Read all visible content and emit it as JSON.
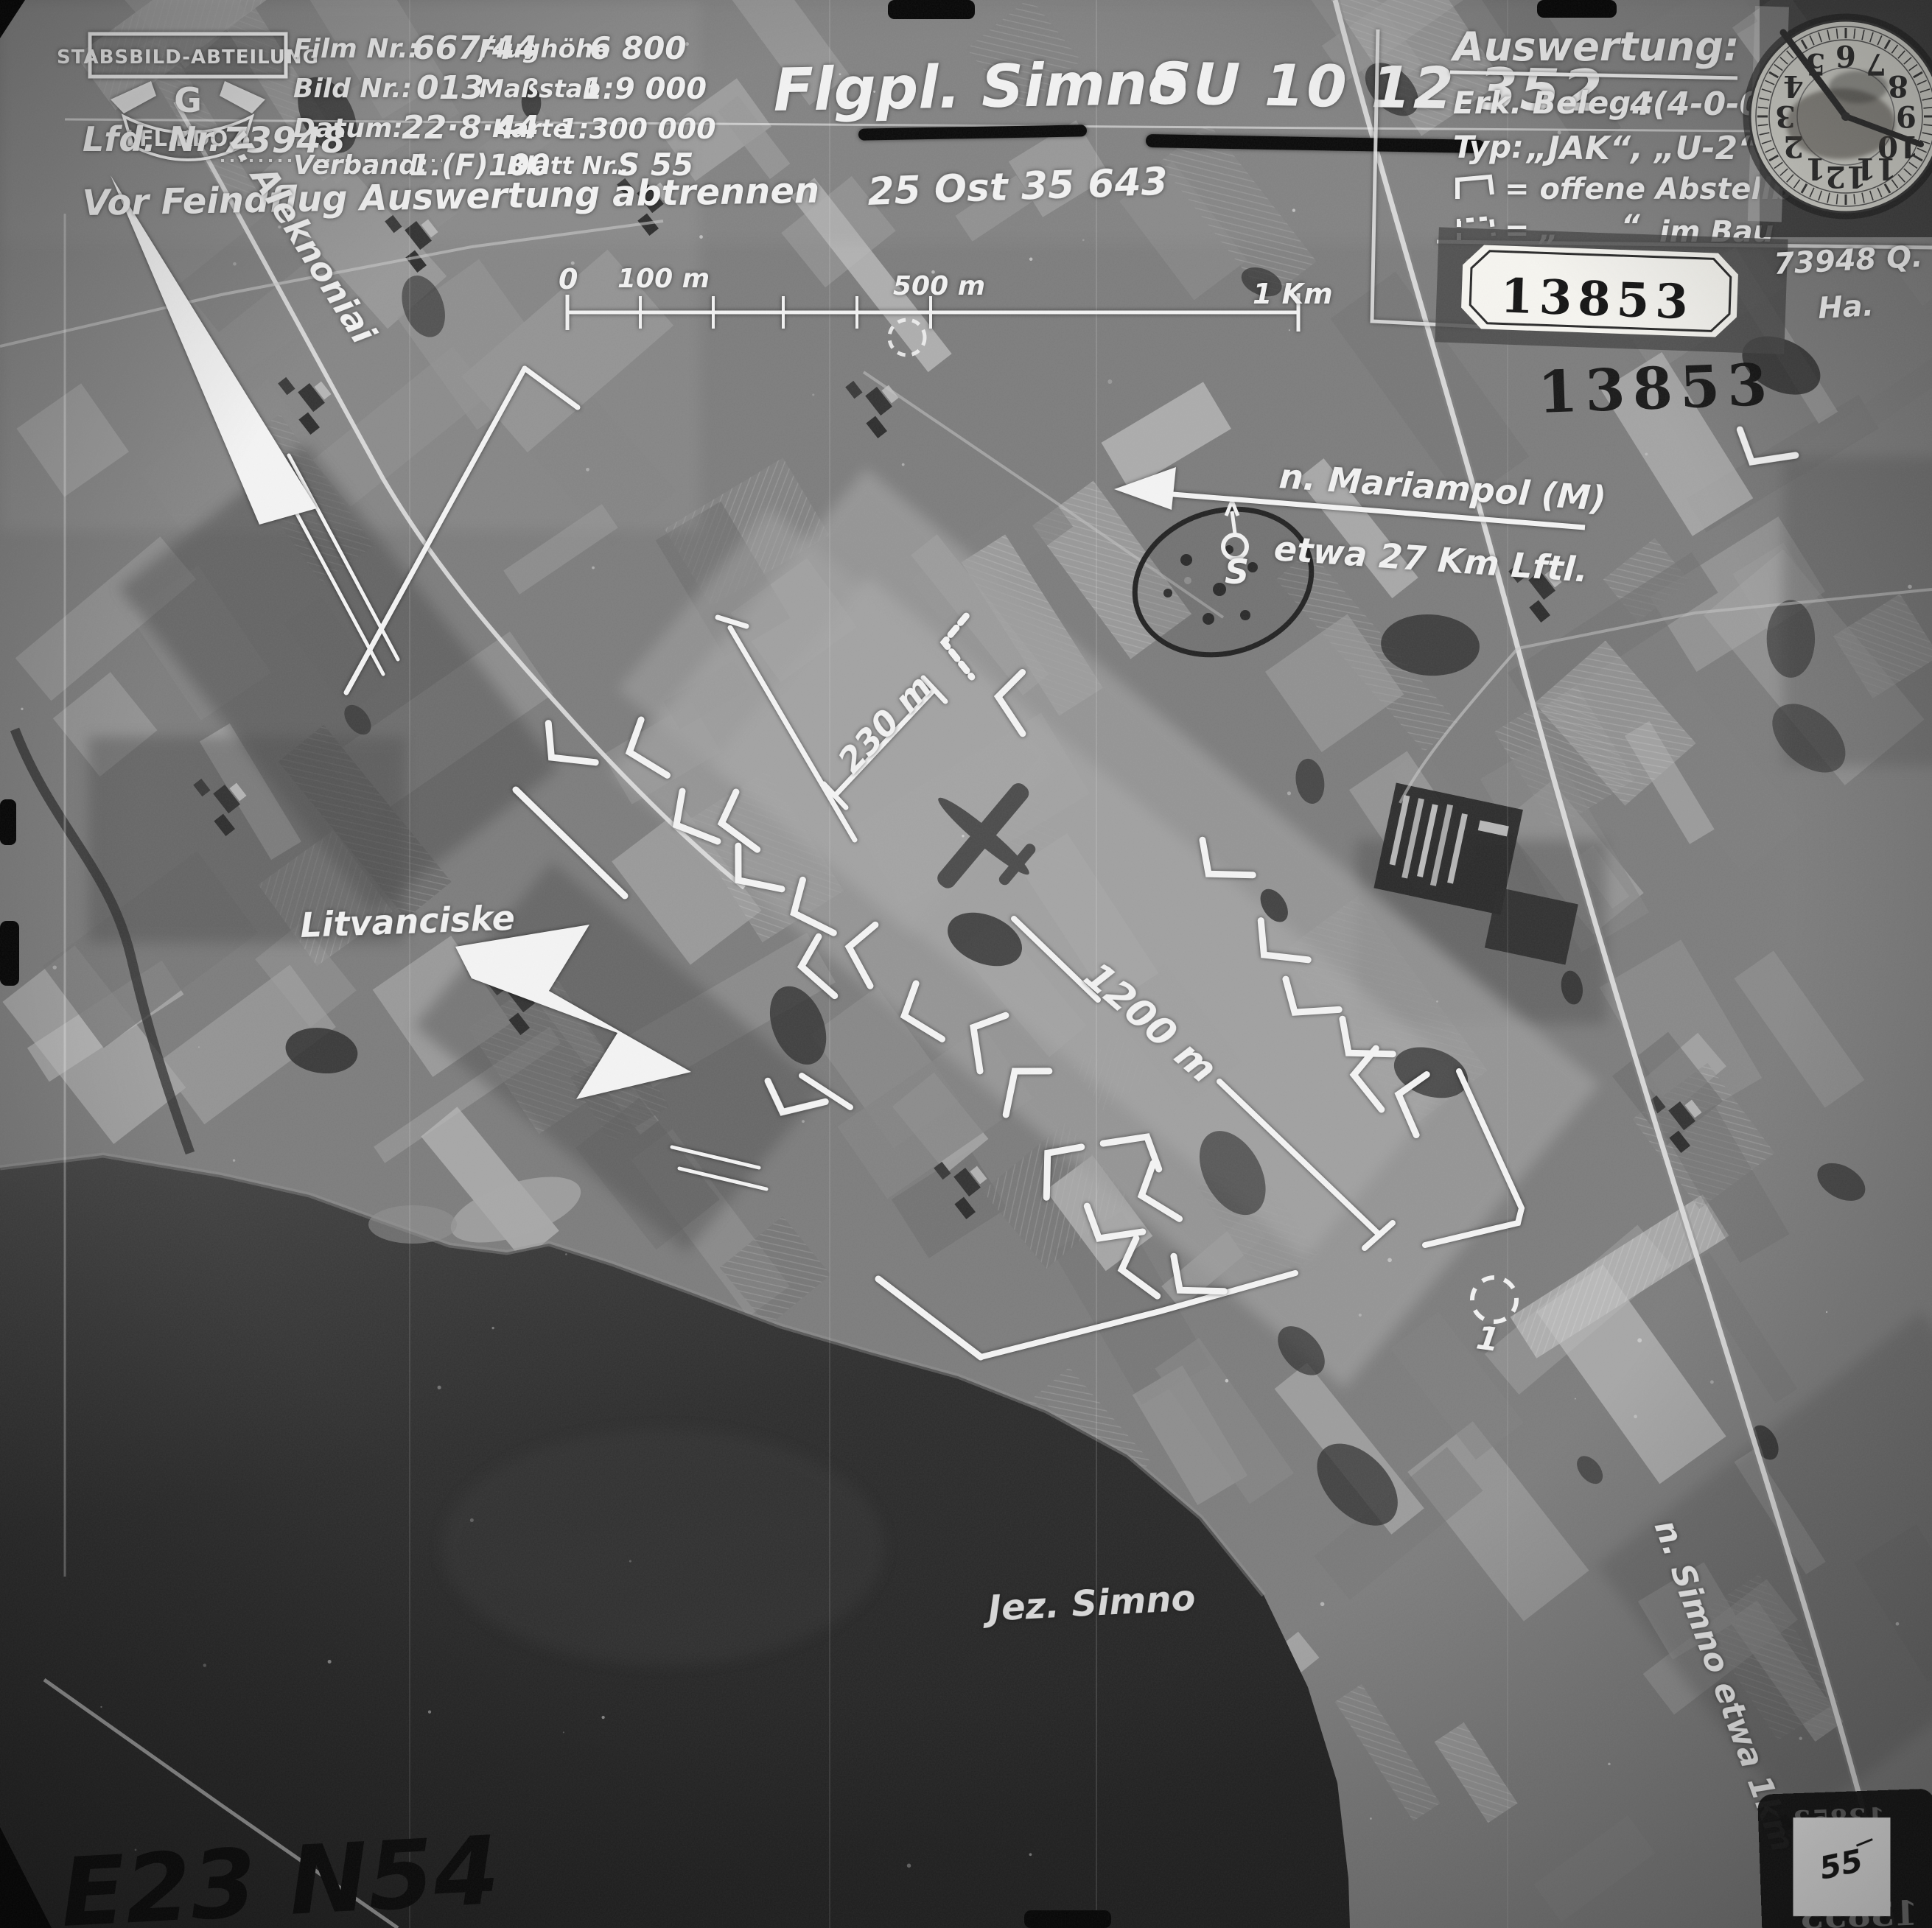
{
  "header": {
    "unit_banner": "STABSBILD-ABTEILUNG",
    "unit_letter": "G",
    "unit_ribbon": "LFL.KDO.6",
    "film_label": "Film Nr.:",
    "film_value": "667/44",
    "flughoehe_label": "Flughöhe",
    "flughoehe_value": "6 800",
    "bild_label": "Bild Nr.:",
    "bild_value": "013",
    "massstab_label": "Maßstab",
    "massstab_value": "1:9 000",
    "datum_label": "Datum:",
    "datum_value": "22·8·44",
    "karte_label": "Karte",
    "karte_value": "1:300 000",
    "lfd_label": "Lfd. Nr.",
    "lfd_value": "73948",
    "verband_label": "Verband:",
    "verband_value": "1.(F)100",
    "blatt_label": "Blatt Nr.:",
    "blatt_value": "S 55",
    "tear_note": "Vor Feindflug Auswertung abtrennen"
  },
  "title": {
    "name": "Flgpl. Simno",
    "code": "SU 10 12 352",
    "grid": "25 Ost 35 643"
  },
  "auswertung": {
    "heading": "Auswertung:",
    "erk_label": "Erk. Beleg.:",
    "erk_value": "4(4-0-0)",
    "typ_label": "Typ:",
    "typ_value": "„JAK“, „U-2“",
    "open_boxes": "= offene Abstellboxen",
    "im_bau_prefix": "= „",
    "im_bau_quote": "“",
    "im_bau": "im Bau",
    "parking_symbol": "1",
    "parking": "= Abstellplatz"
  },
  "stamps": {
    "tag": "13853",
    "repeat": "13853",
    "photo_ref": "73948 Q.",
    "photo_ref2": "Ha.",
    "corner_note": "55",
    "mirror": "13853"
  },
  "scale_bar": {
    "t0": "0",
    "t100": "100 m",
    "t500": "500 m",
    "t1km": "1 Km"
  },
  "map": {
    "road_nw": "v. Aleknoniai",
    "direction_1": "n. Mariampol (M)",
    "direction_2": "etwa 27 Km Lftl.",
    "village": "Litvanciske",
    "runway_width": "230 m",
    "runway_length": "1200 m",
    "lake": "Jez. Simno",
    "road_se": "n. Simno etwa 1km",
    "marker_s": "S",
    "marker_1": "1",
    "archive_mark": "E23 N54"
  },
  "clock": {
    "numbers": [
      "1",
      "2",
      "3",
      "4",
      "5",
      "6",
      "7",
      "8",
      "9",
      "10",
      "11",
      "12"
    ]
  },
  "colors": {
    "annotation": "#f2f2f2",
    "stamp_ink": "#141414",
    "label_paper": "#f6f5f0"
  }
}
